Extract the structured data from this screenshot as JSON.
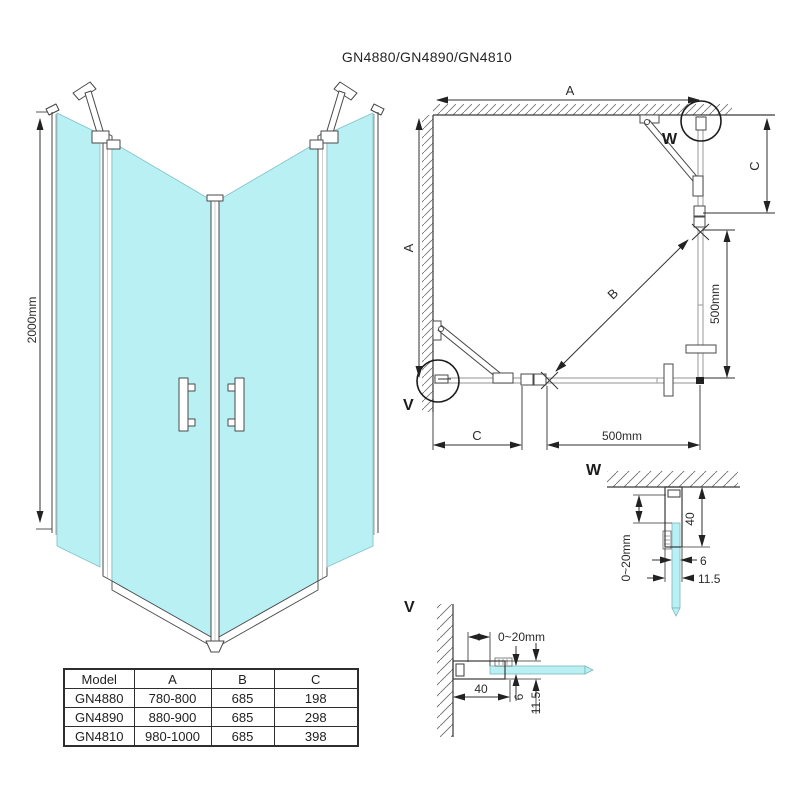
{
  "title": "GN4880/GN4890/GN4810",
  "colors": {
    "glass": "#b9f0f3",
    "glass_edge": "#84c3ca",
    "plan_glass_line": "#a9a9a9",
    "line": "#2f2f2f"
  },
  "iso_view": {
    "height_dim": "2000mm"
  },
  "plan_view": {
    "dim_width_top": "A",
    "dim_width_left": "A",
    "dim_door_diagonal": "B",
    "dim_c_right": "C",
    "dim_c_bottom": "C",
    "dim_right_500": "500mm",
    "dim_bottom_500": "500mm",
    "detail_marker_w": "W",
    "detail_marker_v": "V"
  },
  "detail_w": {
    "label": "W",
    "adjust_range": "0~20mm",
    "profile_depth": "40",
    "glass_thickness": "6",
    "profile_width": "11.5"
  },
  "detail_v": {
    "label": "V",
    "adjust_range": "0~20mm",
    "profile_depth": "40",
    "glass_thickness": "6",
    "profile_width": "11.5"
  },
  "table": {
    "headers": [
      "Model",
      "A",
      "B",
      "C"
    ],
    "rows": [
      {
        "model": "GN4880",
        "a": "780-800",
        "b": "685",
        "c": "198"
      },
      {
        "model": "GN4890",
        "a": "880-900",
        "b": "685",
        "c": "298"
      },
      {
        "model": "GN4810",
        "a": "980-1000",
        "b": "685",
        "c": "398"
      }
    ]
  }
}
